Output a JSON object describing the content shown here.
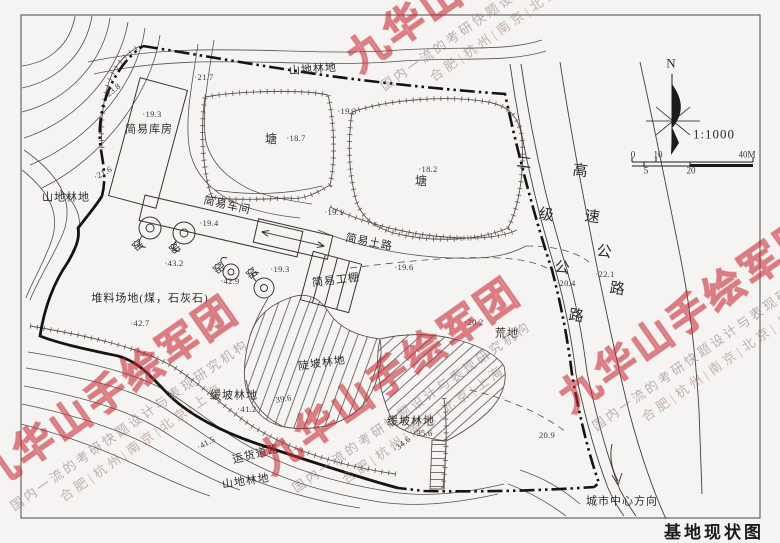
{
  "title": "基地现状图",
  "colors": {
    "paper": "#f5f4f2",
    "ink": "#4a4844",
    "boundary_ink": "#161412",
    "watermark_red": "#c42834"
  },
  "watermark": {
    "brand": "九华山手绘军团",
    "tagline": "国内一流的考研快题设计与表现研究机构",
    "cities": "合肥|杭州|南京|北京|上海",
    "instances": [
      {
        "x": 488,
        "y": -12,
        "rot": -35
      },
      {
        "x": 118,
        "y": 408,
        "rot": -35
      },
      {
        "x": 400,
        "y": 390,
        "rot": -35
      },
      {
        "x": 700,
        "y": 328,
        "rot": -35
      }
    ]
  },
  "map_labels": [
    {
      "name": "area-label-mountain-forest-top",
      "text": "山地林地",
      "x": 313,
      "y": 70,
      "rot": -4,
      "cls": "area"
    },
    {
      "name": "elevation-label",
      "text": "·21.7",
      "x": 204,
      "y": 77,
      "rot": 0,
      "cls": "elev"
    },
    {
      "name": "elevation-label",
      "text": "·23.8",
      "x": 112,
      "y": 91,
      "rot": -38,
      "cls": "elev"
    },
    {
      "name": "elevation-label",
      "text": "·19.3",
      "x": 152,
      "y": 114,
      "rot": 0,
      "cls": "elev"
    },
    {
      "name": "area-label-warehouse",
      "text": "简易库房",
      "x": 149,
      "y": 130,
      "rot": 0,
      "cls": "area"
    },
    {
      "name": "area-label-pond-1",
      "text": "塘",
      "x": 271,
      "y": 139,
      "rot": 0,
      "cls": "big"
    },
    {
      "name": "elevation-label",
      "text": "·18.7",
      "x": 296,
      "y": 138,
      "rot": 0,
      "cls": "elev"
    },
    {
      "name": "elevation-label",
      "text": "·19.3",
      "x": 347,
      "y": 111,
      "rot": 0,
      "cls": "elev"
    },
    {
      "name": "elevation-label",
      "text": "·18.2",
      "x": 428,
      "y": 169,
      "rot": 0,
      "cls": "elev"
    },
    {
      "name": "area-label-pond-2",
      "text": "塘",
      "x": 421,
      "y": 181,
      "rot": 0,
      "cls": "big"
    },
    {
      "name": "area-label-mountain-forest-left",
      "text": "山地林地",
      "x": 66,
      "y": 198,
      "rot": 0,
      "cls": "area"
    },
    {
      "name": "elevation-label",
      "text": "·21.6",
      "x": 103,
      "y": 173,
      "rot": -28,
      "cls": "elev"
    },
    {
      "name": "area-label-workshop",
      "text": "简易车间",
      "x": 227,
      "y": 206,
      "rot": 12,
      "cls": "area"
    },
    {
      "name": "elevation-label",
      "text": "·19.4",
      "x": 209,
      "y": 223,
      "rot": 0,
      "cls": "elev"
    },
    {
      "name": "kiln-label",
      "text": "窑",
      "x": 139,
      "y": 246,
      "rot": -38,
      "cls": "area"
    },
    {
      "name": "kiln-label",
      "text": "窑",
      "x": 176,
      "y": 249,
      "rot": -38,
      "cls": "area"
    },
    {
      "name": "elevation-label",
      "text": "·43.2",
      "x": 174,
      "y": 263,
      "rot": 0,
      "cls": "elev"
    },
    {
      "name": "kiln-label",
      "text": "窑",
      "x": 220,
      "y": 269,
      "rot": -38,
      "cls": "area"
    },
    {
      "name": "elevation-label",
      "text": "·42.9",
      "x": 230,
      "y": 281,
      "rot": 0,
      "cls": "elev"
    },
    {
      "name": "kiln-label",
      "text": "窑",
      "x": 253,
      "y": 274,
      "rot": -38,
      "cls": "area"
    },
    {
      "name": "elevation-label",
      "text": "·19.3",
      "x": 280,
      "y": 269,
      "rot": 0,
      "cls": "elev"
    },
    {
      "name": "road-label-dirt-road",
      "text": "简易土路",
      "x": 369,
      "y": 243,
      "rot": 11,
      "cls": "area"
    },
    {
      "name": "elevation-label",
      "text": "·19.1",
      "x": 334,
      "y": 212,
      "rot": 0,
      "cls": "elev"
    },
    {
      "name": "elevation-label",
      "text": "·19.6",
      "x": 404,
      "y": 267,
      "rot": 0,
      "cls": "elev"
    },
    {
      "name": "area-label-work-shed",
      "text": "简易工棚",
      "x": 336,
      "y": 281,
      "rot": -7,
      "cls": "area"
    },
    {
      "name": "area-label-stockpile",
      "text": "堆料场地(煤，石灰石)",
      "x": 150,
      "y": 299,
      "rot": 0,
      "cls": "area"
    },
    {
      "name": "elevation-label",
      "text": "·42.7",
      "x": 140,
      "y": 323,
      "rot": 0,
      "cls": "elev"
    },
    {
      "name": "elevation-label",
      "text": "·20.2",
      "x": 474,
      "y": 322,
      "rot": 0,
      "cls": "elev"
    },
    {
      "name": "area-label-wasteland",
      "text": "荒地",
      "x": 507,
      "y": 334,
      "rot": 0,
      "cls": "area"
    },
    {
      "name": "area-label-steep-slope-forest",
      "text": "陡坡林地",
      "x": 322,
      "y": 364,
      "rot": -8,
      "cls": "area"
    },
    {
      "name": "elevation-label",
      "text": "·39.6",
      "x": 282,
      "y": 399,
      "rot": -10,
      "cls": "elev"
    },
    {
      "name": "area-label-gentle-slope-forest-left",
      "text": "缓坡林地",
      "x": 234,
      "y": 396,
      "rot": 0,
      "cls": "area"
    },
    {
      "name": "elevation-label",
      "text": "·41.2",
      "x": 247,
      "y": 409,
      "rot": 0,
      "cls": "elev"
    },
    {
      "name": "elevation-label",
      "text": "·41.5",
      "x": 206,
      "y": 443,
      "rot": -28,
      "cls": "elev"
    },
    {
      "name": "road-label-freight-road",
      "text": "运货道路",
      "x": 256,
      "y": 455,
      "rot": -14,
      "cls": "area"
    },
    {
      "name": "area-label-mountain-forest-bottom",
      "text": "山地林地",
      "x": 246,
      "y": 482,
      "rot": -8,
      "cls": "area"
    },
    {
      "name": "area-label-gentle-slope-forest-right",
      "text": "缓坡林地",
      "x": 411,
      "y": 422,
      "rot": 0,
      "cls": "area"
    },
    {
      "name": "elevation-label",
      "text": "·35.6",
      "x": 423,
      "y": 433,
      "rot": 0,
      "cls": "elev"
    },
    {
      "name": "elevation-label",
      "text": "·34.6",
      "x": 402,
      "y": 444,
      "rot": -38,
      "cls": "elev"
    },
    {
      "name": "elevation-label",
      "text": "20.9",
      "x": 547,
      "y": 435,
      "rot": 0,
      "cls": "elev"
    },
    {
      "name": "elevation-label",
      "text": "·20.4",
      "x": 566,
      "y": 283,
      "rot": 0,
      "cls": "elev"
    },
    {
      "name": "elevation-label",
      "text": "·22.1",
      "x": 605,
      "y": 274,
      "rot": 0,
      "cls": "elev"
    },
    {
      "name": "road-label-secondary-road-char",
      "text": "二",
      "x": 524,
      "y": 164,
      "rot": 8,
      "cls": "roadchar"
    },
    {
      "name": "road-label-secondary-road-char",
      "text": "级",
      "x": 546,
      "y": 216,
      "rot": 8,
      "cls": "roadchar"
    },
    {
      "name": "road-label-secondary-road-char",
      "text": "公",
      "x": 562,
      "y": 269,
      "rot": 8,
      "cls": "roadchar"
    },
    {
      "name": "road-label-secondary-road-char",
      "text": "路",
      "x": 576,
      "y": 317,
      "rot": 8,
      "cls": "roadchar"
    },
    {
      "name": "road-label-highway-char",
      "text": "高",
      "x": 580,
      "y": 172,
      "rot": 8,
      "cls": "roadchar"
    },
    {
      "name": "road-label-highway-char",
      "text": "速",
      "x": 592,
      "y": 218,
      "rot": 8,
      "cls": "roadchar"
    },
    {
      "name": "road-label-highway-char",
      "text": "公",
      "x": 604,
      "y": 253,
      "rot": 8,
      "cls": "roadchar"
    },
    {
      "name": "road-label-highway-char",
      "text": "路",
      "x": 617,
      "y": 290,
      "rot": 8,
      "cls": "roadchar"
    },
    {
      "name": "city-center-direction-label",
      "text": "城市中心方向",
      "x": 622,
      "y": 502,
      "rot": 0,
      "cls": "dir"
    },
    {
      "name": "north-label",
      "text": "N",
      "x": 671,
      "y": 63,
      "rot": 0,
      "cls": "north"
    },
    {
      "name": "scale-text",
      "text": "1:1000",
      "x": 714,
      "y": 134,
      "rot": 0,
      "cls": "scaletxt"
    },
    {
      "name": "scale-bar-tick",
      "text": "0",
      "x": 633,
      "y": 155,
      "rot": 0,
      "cls": "scalenum"
    },
    {
      "name": "scale-bar-tick",
      "text": "10",
      "x": 658,
      "y": 155,
      "rot": 0,
      "cls": "scalenum"
    },
    {
      "name": "scale-bar-tick",
      "text": "40M",
      "x": 747,
      "y": 155,
      "rot": 0,
      "cls": "scalenum"
    },
    {
      "name": "scale-bar-tick",
      "text": "5",
      "x": 646,
      "y": 171,
      "rot": 0,
      "cls": "scalenum"
    },
    {
      "name": "scale-bar-tick",
      "text": "20",
      "x": 691,
      "y": 171,
      "rot": 0,
      "cls": "scalenum"
    }
  ]
}
